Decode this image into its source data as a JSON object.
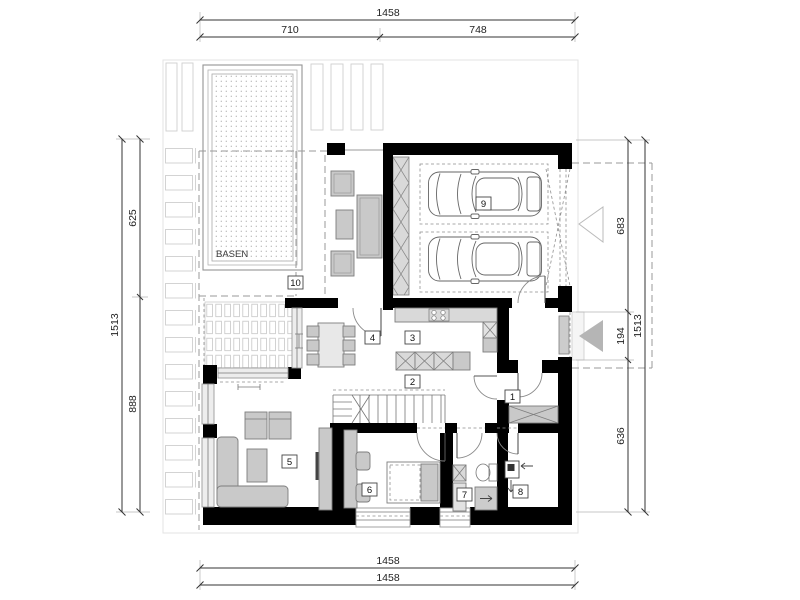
{
  "plan": {
    "pool_label": "BASEN",
    "room_labels": {
      "r1": "1",
      "r2": "2",
      "r3": "3",
      "r4": "4",
      "r5": "5",
      "r6": "6",
      "r7": "7",
      "r8": "8",
      "r9": "9",
      "r10": "10"
    },
    "dim": {
      "top": {
        "total": "1458",
        "left": "710",
        "right": "748"
      },
      "left": {
        "total": "1513",
        "upper": "625",
        "lower": "888"
      },
      "right": {
        "upper": "683",
        "middle": "194",
        "lower": "636",
        "total": "1513"
      },
      "bottom": {
        "first": "1458",
        "second": "1458"
      }
    },
    "colors": {
      "wall": "#000000",
      "furniture": "#c9c9c9",
      "glass": "#ededed",
      "entrance_arrow": "#b5b5b5"
    }
  }
}
